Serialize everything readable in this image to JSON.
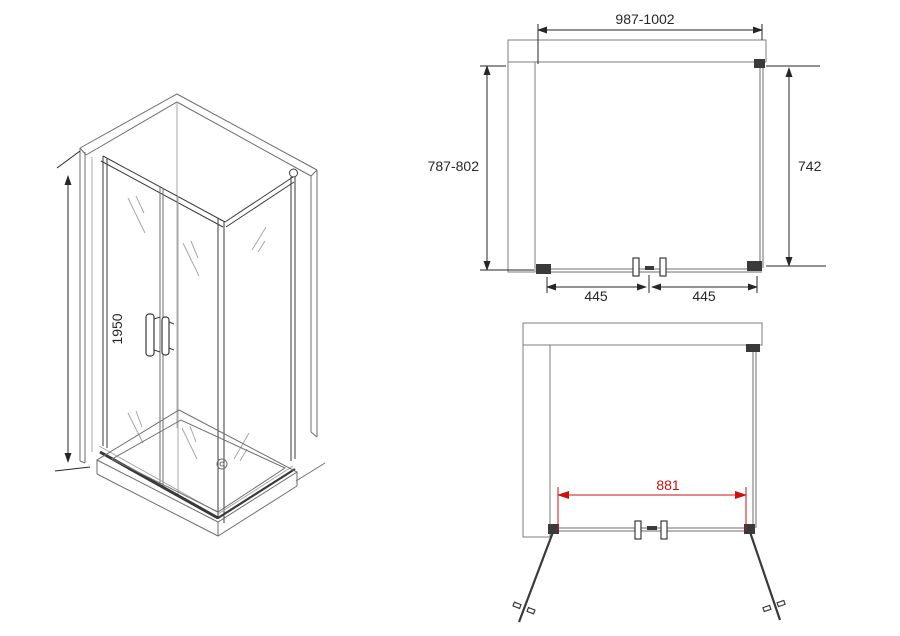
{
  "colors": {
    "accent_red": "#cc1111",
    "line": "#6e6e6e",
    "line_dark": "#3a3a3a",
    "dimension": "#262626",
    "brick": "#9a9a9a"
  },
  "views": {
    "isometric": {
      "height_dim": "1950"
    },
    "top_plan": {
      "width_dim": "987-1002",
      "depth_dim": "787-802",
      "side_panel_dim": "742",
      "left_door_dim": "445",
      "right_door_dim": "445"
    },
    "front_plan": {
      "opening_dim": "881"
    }
  }
}
